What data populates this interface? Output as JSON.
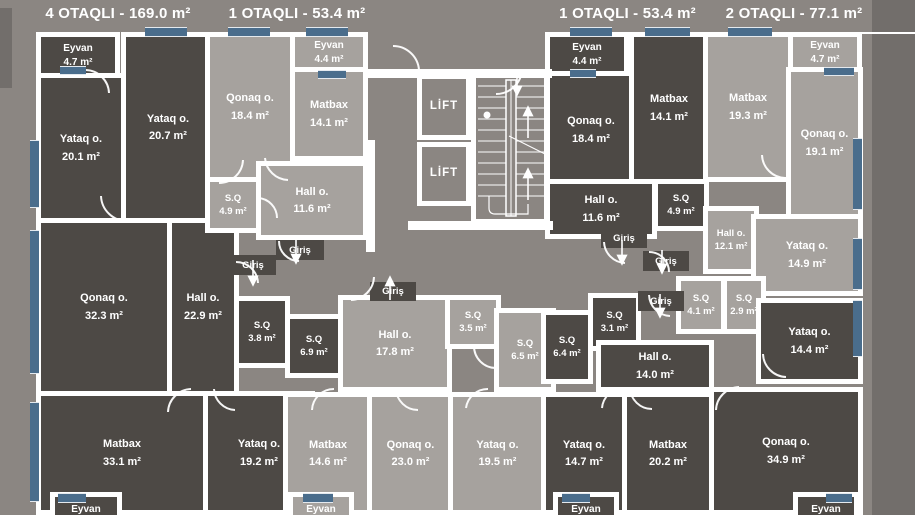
{
  "header": {
    "titles": [
      "4 OTAQLI - 169.0 m²",
      "1 OTAQLI - 53.4 m²",
      "1 OTAQLI - 53.4 m²",
      "2 OTAQLI - 77.1 m²"
    ]
  },
  "labels": {
    "lift": "LİFT",
    "giris": "Giriş",
    "eyvan": "Eyvan"
  },
  "rooms": {
    "l_eyvan_top": {
      "name": "Eyvan",
      "area": "4.7 m²"
    },
    "l_yataq1": {
      "name": "Yataq o.",
      "area": "20.1 m²"
    },
    "l_yataq2": {
      "name": "Yataq o.",
      "area": "20.7 m²"
    },
    "l_qonaq": {
      "name": "Qonaq o.",
      "area": "32.3 m²"
    },
    "l_hall": {
      "name": "Hall o.",
      "area": "22.9 m²"
    },
    "l_sq1": {
      "name": "S.Q",
      "area": "3.8 m²"
    },
    "l_sq2": {
      "name": "S.Q",
      "area": "6.9 m²"
    },
    "l_matbax": {
      "name": "Matbax",
      "area": "33.1 m²"
    },
    "l_yataq3": {
      "name": "Yataq o.",
      "area": "19.2 m²"
    },
    "cl_eyvan": {
      "name": "Eyvan",
      "area": "4.4 m²"
    },
    "cl_qonaq": {
      "name": "Qonaq o.",
      "area": "18.4 m²"
    },
    "cl_matbax": {
      "name": "Matbax",
      "area": "14.1 m²"
    },
    "cl_sq": {
      "name": "S.Q",
      "area": "4.9 m²"
    },
    "cl_hall": {
      "name": "Hall o.",
      "area": "11.6 m²"
    },
    "cr_eyvan": {
      "name": "Eyvan",
      "area": "4.4 m²"
    },
    "cr_qonaq": {
      "name": "Qonaq o.",
      "area": "18.4 m²"
    },
    "cr_matbax": {
      "name": "Matbax",
      "area": "14.1 m²"
    },
    "cr_hall": {
      "name": "Hall o.",
      "area": "11.6 m²"
    },
    "cr_sq": {
      "name": "S.Q",
      "area": "4.9 m²"
    },
    "r_matbax": {
      "name": "Matbax",
      "area": "19.3 m²"
    },
    "r_eyvan": {
      "name": "Eyvan",
      "area": "4.7 m²"
    },
    "r_qonaq": {
      "name": "Qonaq o.",
      "area": "19.1 m²"
    },
    "r_hall": {
      "name": "Hall o.",
      "area": "12.1 m²"
    },
    "r_yataq1": {
      "name": "Yataq o.",
      "area": "14.9 m²"
    },
    "r_sq1": {
      "name": "S.Q",
      "area": "4.1 m²"
    },
    "r_sq2": {
      "name": "S.Q",
      "area": "2.9 m²"
    },
    "b_hall": {
      "name": "Hall o.",
      "area": "17.8 m²"
    },
    "b_sq1": {
      "name": "S.Q",
      "area": "3.5 m²"
    },
    "b_sq2": {
      "name": "S.Q",
      "area": "6.5 m²"
    },
    "b_matbax": {
      "name": "Matbax",
      "area": "14.6 m²"
    },
    "b_qonaq": {
      "name": "Qonaq o.",
      "area": "23.0 m²"
    },
    "b_yataq": {
      "name": "Yataq o.",
      "area": "19.5 m²"
    },
    "br_sq1": {
      "name": "S.Q",
      "area": "6.4 m²"
    },
    "br_sq2": {
      "name": "S.Q",
      "area": "3.1 m²"
    },
    "br_hall": {
      "name": "Hall o.",
      "area": "14.0 m²"
    },
    "br_yataq1": {
      "name": "Yataq o.",
      "area": "14.7 m²"
    },
    "br_matbax": {
      "name": "Matbax",
      "area": "20.2 m²"
    },
    "br_qonaq": {
      "name": "Qonaq o.",
      "area": "34.9 m²"
    },
    "br_yataq2": {
      "name": "Yataq o.",
      "area": "14.4 m²"
    }
  },
  "colors": {
    "background": "#8b8682",
    "room_dark": "#4d4945",
    "room_light": "#a6a29e",
    "wall": "#ffffff",
    "window": "#4a6d8c",
    "outside_shadow": "#726e6b",
    "title_text": "#ffffff"
  }
}
